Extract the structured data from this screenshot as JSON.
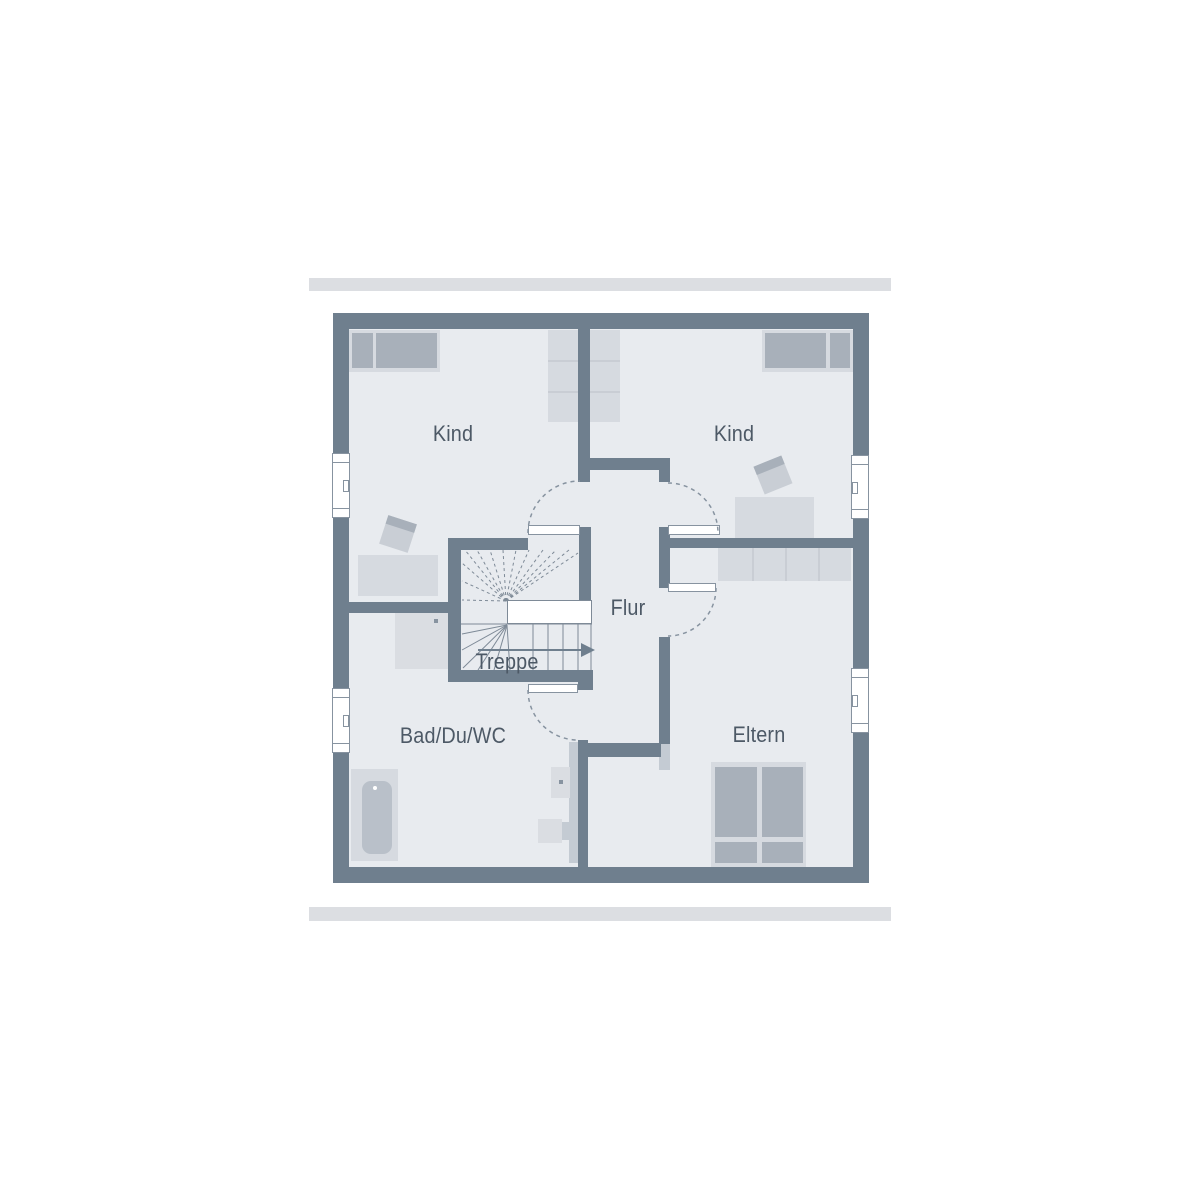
{
  "labels": {
    "kind_left": "Kind",
    "kind_right": "Kind",
    "flur": "Flur",
    "treppe": "Treppe",
    "bad": "Bad/Du/WC",
    "eltern": "Eltern"
  },
  "colors": {
    "wall": "#6f7f8e",
    "floor": "#e8ebef",
    "bar": "#dcdee2",
    "furniture_light": "#d6dae0",
    "furniture_mid": "#a8b0ba",
    "fixture": "#dadde2",
    "fixture_dark": "#b9c0c9",
    "strip": "#c4cbd3",
    "divider": "#c9cdd4",
    "chair": "#c9ced5",
    "line": "#8793a0",
    "stair_line": "#7e8a97",
    "text": "#4d5966"
  }
}
